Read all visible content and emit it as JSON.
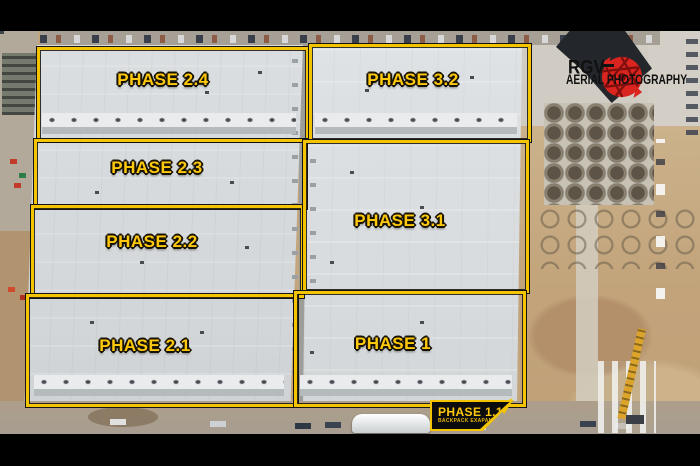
{
  "watermark": {
    "brand": "RGV",
    "tagline": "AERIAL PHOTOGRAPHY"
  },
  "phase_labels": [
    {
      "label": "PHASE 2.4"
    },
    {
      "label": "PHASE 3.2"
    },
    {
      "label": "PHASE 2.3"
    },
    {
      "label": "PHASE 2.2"
    },
    {
      "label": "PHASE 3.1"
    },
    {
      "label": "PHASE 2.1"
    },
    {
      "label": "PHASE 1"
    }
  ],
  "expansion_label": {
    "title": "PHASE 1.1",
    "subtitle": "BACKPACK EXAPANTION"
  },
  "colors": {
    "phase_outline": "#f5c400",
    "phase_text": "#fec90d",
    "watermark_red": "#d92420",
    "watermark_text": "#101010",
    "letterbox": "#000000"
  }
}
